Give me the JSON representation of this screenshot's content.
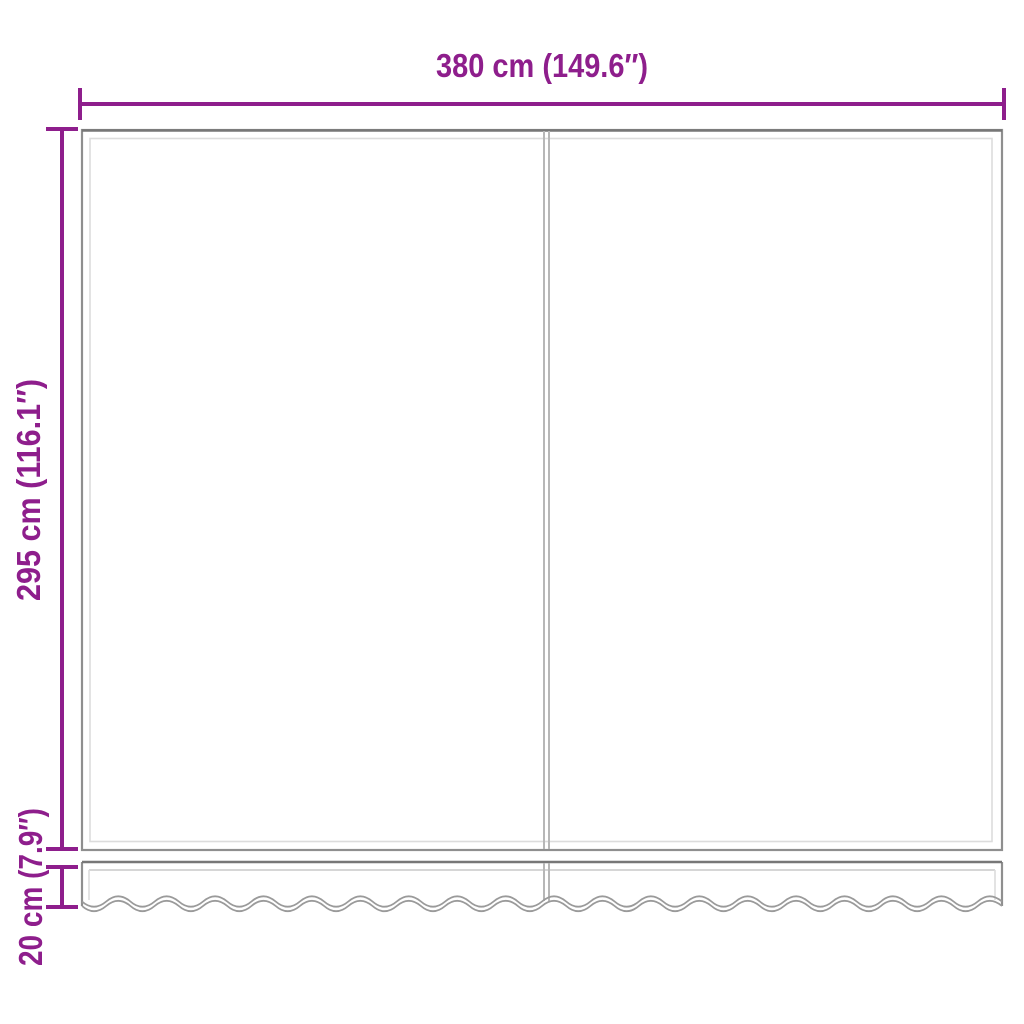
{
  "diagram": {
    "type": "product-dimension-diagram",
    "subject": "awning-fabric-with-valance",
    "width_label": "380 cm (149.6″)",
    "height_label": "295 cm (116.1″)",
    "valance_height_label": "20 cm (7.9″)",
    "accent_color": "#8E1E8C",
    "outline_color": "#8f8f8f",
    "background_color": "#ffffff"
  }
}
